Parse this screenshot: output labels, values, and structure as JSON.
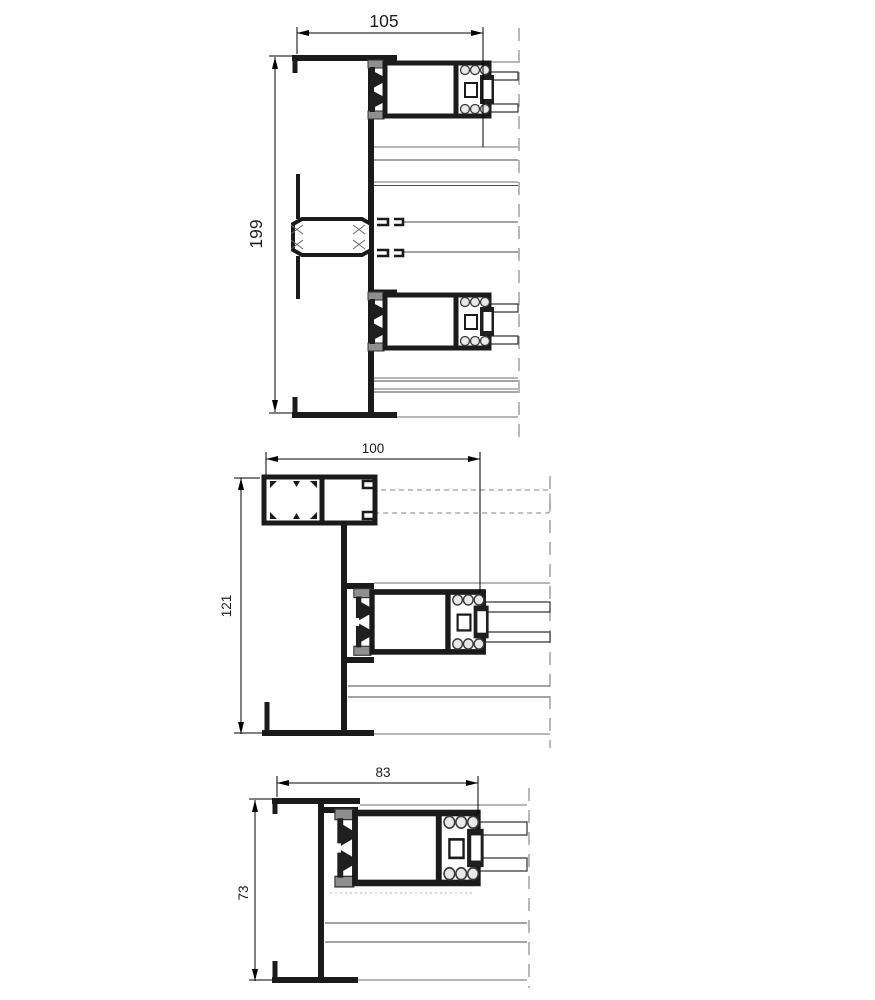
{
  "drawing": {
    "description": "Three cross-section detail drawings of aluminium sliding window profiles",
    "sections": [
      {
        "name": "top-section",
        "width_dim": "105",
        "height_dim": "199"
      },
      {
        "name": "middle-section",
        "width_dim": "100",
        "height_dim": "121"
      },
      {
        "name": "bottom-section",
        "width_dim": "83",
        "height_dim": "73"
      }
    ],
    "colors": {
      "profile": "#1b1b1b",
      "reference_line": "#8a8a8a",
      "break_line": "#9a9a9a",
      "background": "#ffffff"
    }
  }
}
